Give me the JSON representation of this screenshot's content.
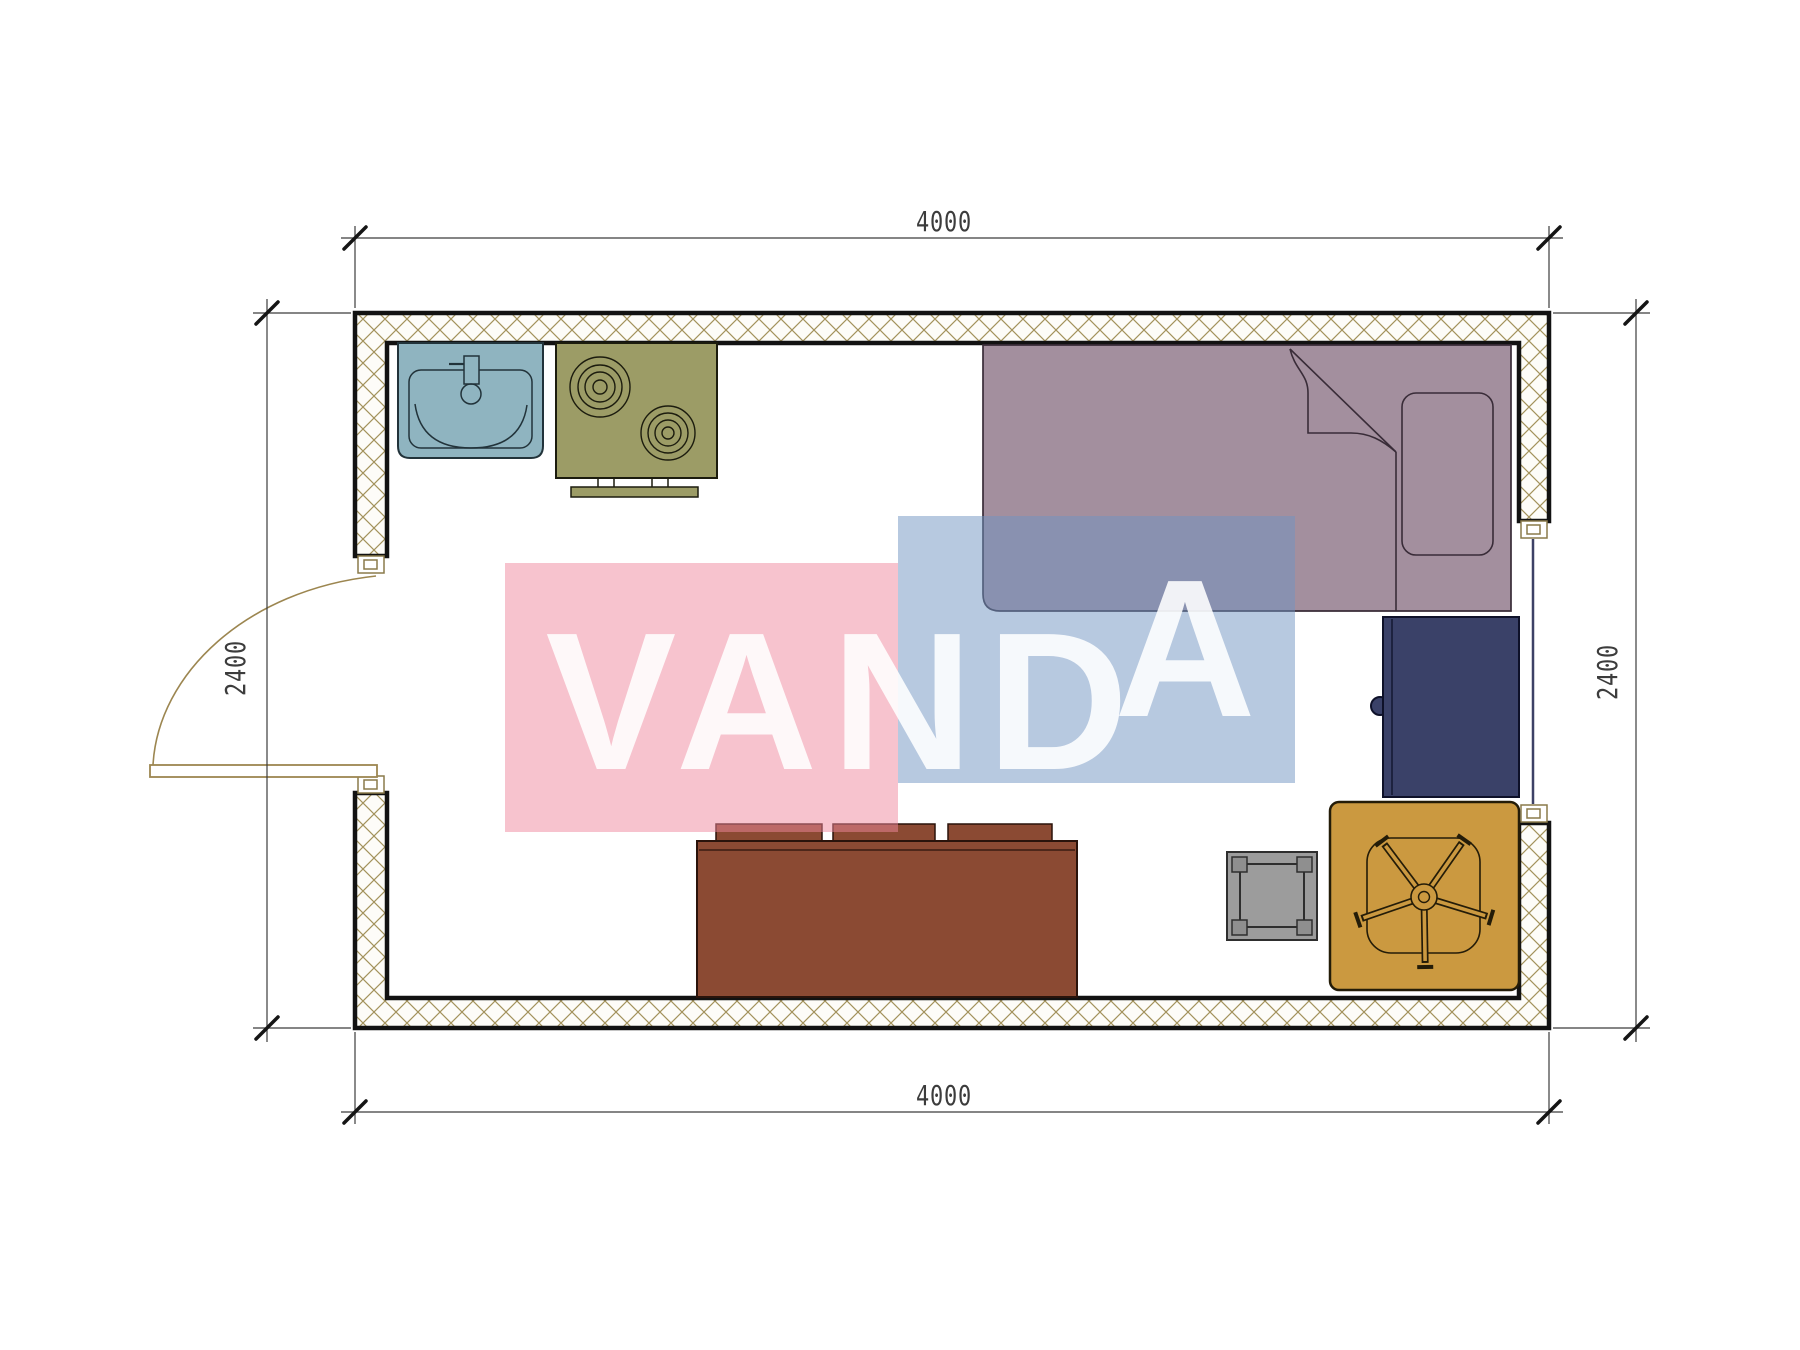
{
  "title": "studio-room-floor-plan",
  "watermark": {
    "text": "VANDA",
    "text_main": "VAND",
    "text_accent": "A",
    "pink": "#EF879D",
    "blue": "#6F93C1",
    "text_color": "#FFFFFF"
  },
  "dimensions": {
    "width_top": "4000",
    "width_bottom": "4000",
    "height_left": "2400",
    "height_right": "2400"
  },
  "colors": {
    "wall_hatch": "#A3925C",
    "wall_border": "#121212",
    "sink": "#8FB4C0",
    "stove": "#9C9C66",
    "bed": "#A38F9E",
    "desk": "#3A4168",
    "sofa": "#8B4A33",
    "stool": "#9C9C9C",
    "table": "#CB9940",
    "door": "#9C8650",
    "window": "#3D4166",
    "dim_line": "#3C3C3C"
  }
}
